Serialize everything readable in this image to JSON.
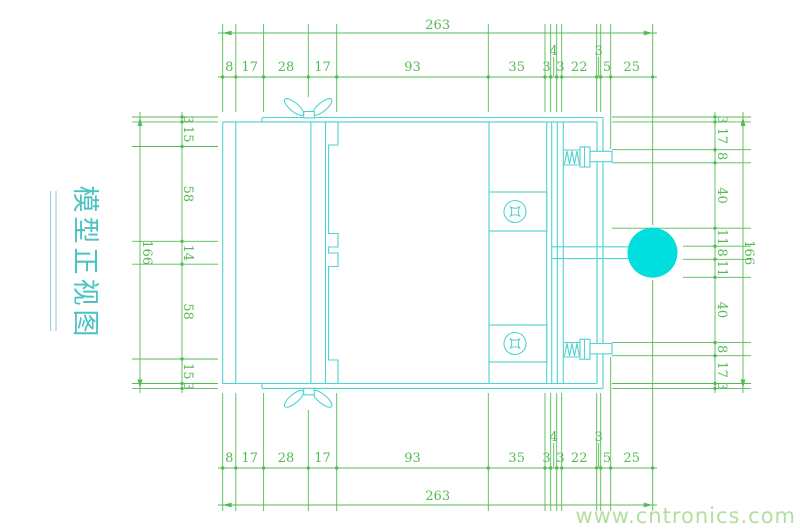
{
  "title_label": {
    "text": "模型正视图"
  },
  "watermark": {
    "text": "www.cntronics.com"
  },
  "colors": {
    "drawing_line": "#4fd2d2",
    "knob_fill": "#00dede",
    "dimension_green": "#55bb55",
    "watermark_green": "#b2de9e",
    "title_cyan": "#49c3c3"
  },
  "dims": {
    "top": {
      "overall": "263",
      "segments": [
        "8",
        "17",
        "28",
        "17",
        "93",
        "35",
        "3",
        "4",
        "3",
        "22",
        "3",
        "5",
        "25"
      ]
    },
    "bottom": {
      "overall": "263",
      "segments": [
        "8",
        "17",
        "28",
        "17",
        "93",
        "35",
        "3",
        "4",
        "3",
        "22",
        "3",
        "5",
        "25"
      ]
    },
    "left": {
      "overall": "166",
      "segments": [
        "3",
        "15",
        "58",
        "14",
        "58",
        "15",
        "3"
      ]
    },
    "right": {
      "overall": "166",
      "segments": [
        "3",
        "17",
        "8",
        "40",
        "11",
        "8",
        "11",
        "40",
        "8",
        "17",
        "3"
      ]
    }
  }
}
